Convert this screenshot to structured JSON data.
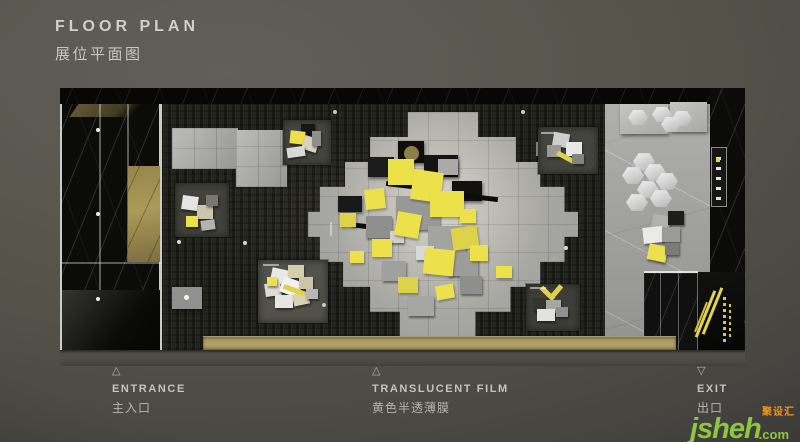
{
  "title": {
    "en": "FLOOR PLAN",
    "zh": "展位平面图"
  },
  "legend": {
    "items": [
      {
        "marker": "△",
        "en": "ENTRANCE",
        "zh": "主入口"
      },
      {
        "marker": "△",
        "en": "TRANSLUCENT FILM",
        "zh": "黄色半透薄膜"
      },
      {
        "marker": "▽",
        "en": "EXIT",
        "zh": "出口"
      }
    ]
  },
  "watermark": {
    "name": "jsheh",
    "tld": ".com",
    "badge": "聚设汇"
  },
  "palette": {
    "accent_yellow": "#ece14b",
    "gold_panel": "#a3914f",
    "beige_floor": "#a89a63",
    "black_marble": "#0b0b0a",
    "gray_tile": "#a9a9a6",
    "watermark_green": "#8dc63f",
    "watermark_orange": "#f7941d"
  }
}
